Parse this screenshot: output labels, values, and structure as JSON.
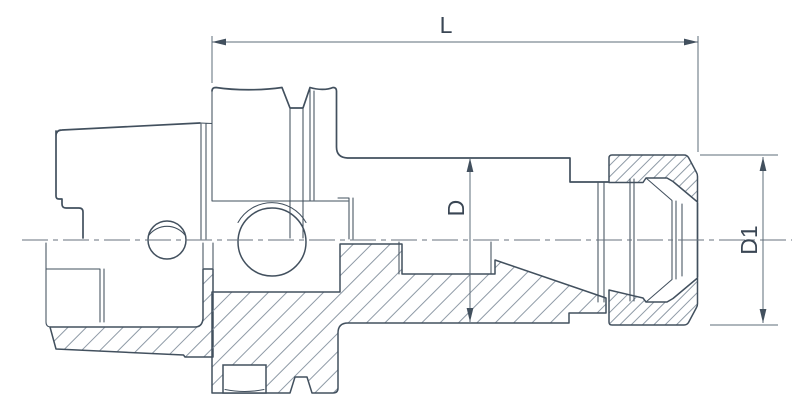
{
  "drawing": {
    "type": "technical-drawing",
    "subject": "collet-chuck-tool-holder-cross-section",
    "dimensions": {
      "length_label": "L",
      "body_diameter_label": "D",
      "nut_diameter_label": "D1"
    },
    "colors": {
      "background": "#ffffff",
      "outline": "#42505e",
      "dimension_line": "#5e6c7a",
      "centerline": "#67727e",
      "hatch": "#8e9aa6",
      "text": "#3a4654"
    }
  }
}
